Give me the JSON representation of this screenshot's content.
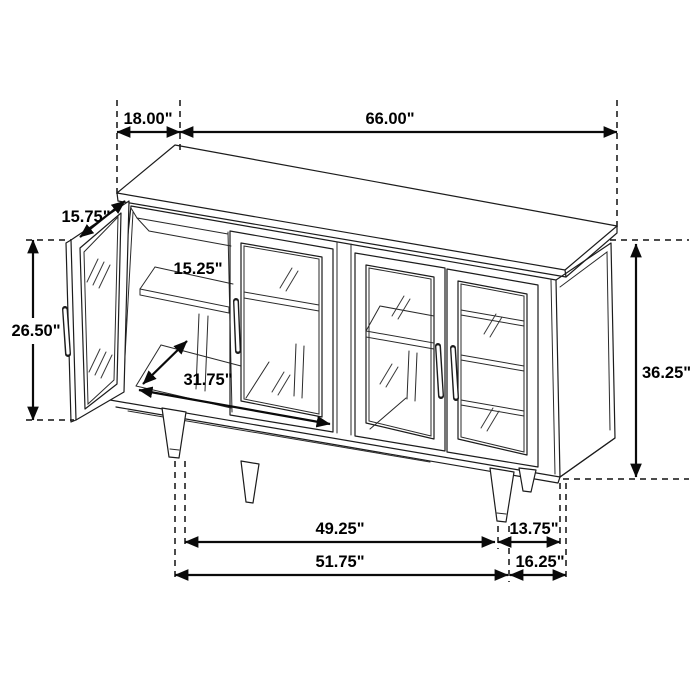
{
  "meta": {
    "diagram_type": "furniture-dimension-line-drawing",
    "subject": "4-door glass sideboard cabinet with tapered legs, left door open",
    "units": "inches",
    "background_color": "#ffffff",
    "line_color": "#1c1c1c",
    "text_color": "#000000"
  },
  "dimensions": {
    "top_depth": {
      "label": "18.00\"",
      "value": 18.0,
      "measures": "cabinet top depth (front-to-back projection)"
    },
    "top_width": {
      "label": "66.00\"",
      "value": 66.0,
      "measures": "overall cabinet width"
    },
    "door_width": {
      "label": "15.75\"",
      "value": 15.75,
      "measures": "open door width (diagonal along door top edge)"
    },
    "door_height": {
      "label": "26.50\"",
      "value": 26.5,
      "measures": "door height"
    },
    "shelf_depth": {
      "label": "15.25\"",
      "value": 15.25,
      "measures": "interior shelf depth"
    },
    "interior_width": {
      "label": "31.75\"",
      "value": 31.75,
      "measures": "interior compartment width"
    },
    "overall_height": {
      "label": "36.25\"",
      "value": 36.25,
      "measures": "overall cabinet height"
    },
    "inner_leg_span": {
      "label": "49.25\"",
      "value": 49.25,
      "measures": "span between front legs (inner)"
    },
    "leg_back_offset": {
      "label": "13.75\"",
      "value": 13.75,
      "measures": "front leg to back edge"
    },
    "outer_leg_span": {
      "label": "51.75\"",
      "value": 51.75,
      "measures": "span between front legs (outer)"
    },
    "base_depth": {
      "label": "16.25\"",
      "value": 16.25,
      "measures": "base depth at floor"
    }
  }
}
